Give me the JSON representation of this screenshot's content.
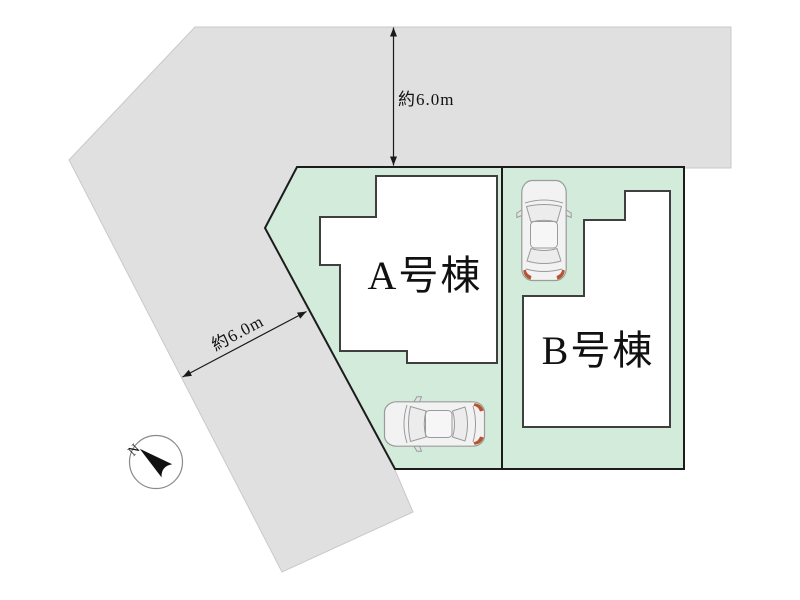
{
  "page": {
    "background": "#ffffff"
  },
  "site_plan": {
    "road": {
      "color": "#e0e0e0"
    },
    "lot": {
      "color": "#d2ebda",
      "outline_color": "#1c1c1c"
    },
    "buildings": [
      {
        "label": "A号棟"
      },
      {
        "label": "B号棟"
      }
    ],
    "dimensions": [
      {
        "label": "約6.0m",
        "position": "north-road"
      },
      {
        "label": "約6.0m",
        "position": "west-road"
      }
    ],
    "compass": {
      "label": "N"
    },
    "cars": {
      "count": 2,
      "tail_light_color": "#b5542e"
    }
  }
}
